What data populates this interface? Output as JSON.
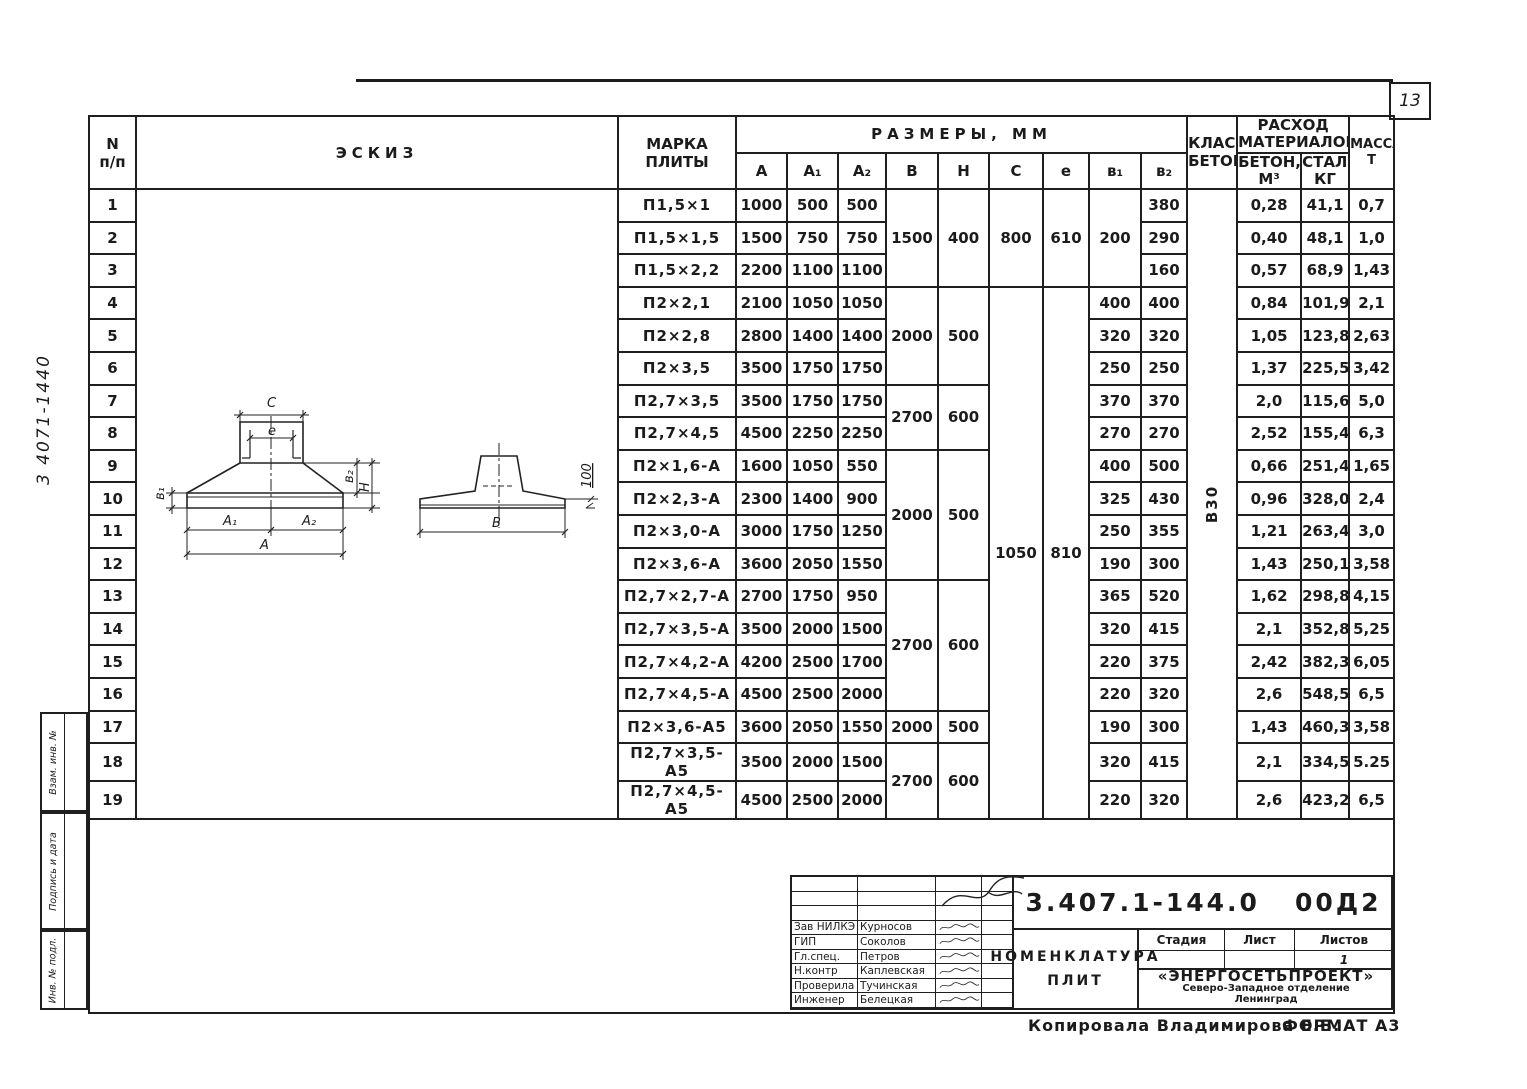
{
  "page": {
    "number": "13",
    "margin_code": "3 4071-1440",
    "stamps": [
      "Взам. инв. №",
      "Подпись и дата",
      "Инв. № подл."
    ],
    "copy_note": "Копировала  Владимирова Е.Б.",
    "format_note": "ФОРМАТ А3"
  },
  "table": {
    "header": {
      "num_l1": "N",
      "num_l2": "п/п",
      "sketch": "ЭСКИЗ",
      "mark_l1": "МАРКА",
      "mark_l2": "ПЛИТЫ",
      "dims": "РАЗМЕРЫ, ММ",
      "dim_cols": [
        "A",
        "A₁",
        "A₂",
        "B",
        "H",
        "C",
        "e",
        "в₁",
        "в₂"
      ],
      "class_l1": "КЛАСС",
      "class_l2": "БЕТОНА",
      "materials_l1": "РАСХОД",
      "materials_l2": "МАТЕРИАЛОВ",
      "concrete_l1": "БЕТОН,",
      "concrete_l2": "М³",
      "steel_l1": "СТАЛЬ,",
      "steel_l2": "КГ",
      "mass_l1": "МАССА,",
      "mass_l2": "Т"
    },
    "concrete_class": "В30",
    "rows": [
      {
        "n": "1",
        "mark": "П1,5×1",
        "A": "1000",
        "A1": "500",
        "A2": "500",
        "B": {
          "t": "1500",
          "rs": 3
        },
        "H": {
          "t": "400",
          "rs": 3
        },
        "C": {
          "t": "800",
          "rs": 3
        },
        "e": {
          "t": "610",
          "rs": 3
        },
        "B1": {
          "t": "200",
          "rs": 3
        },
        "B2": "380",
        "concrete": "0,28",
        "steel": "41,1",
        "mass": "0,7"
      },
      {
        "n": "2",
        "mark": "П1,5×1,5",
        "A": "1500",
        "A1": "750",
        "A2": "750",
        "B2": "290",
        "concrete": "0,40",
        "steel": "48,1",
        "mass": "1,0"
      },
      {
        "n": "3",
        "mark": "П1,5×2,2",
        "A": "2200",
        "A1": "1100",
        "A2": "1100",
        "B2": "160",
        "concrete": "0,57",
        "steel": "68,9",
        "mass": "1,43"
      },
      {
        "n": "4",
        "mark": "П2×2,1",
        "A": "2100",
        "A1": "1050",
        "A2": "1050",
        "B": {
          "t": "2000",
          "rs": 3
        },
        "H": {
          "t": "500",
          "rs": 3
        },
        "C": {
          "t": "1050",
          "rs": 16
        },
        "e": {
          "t": "810",
          "rs": 16
        },
        "B1": "400",
        "B2": "400",
        "concrete": "0,84",
        "steel": "101,9",
        "mass": "2,1"
      },
      {
        "n": "5",
        "mark": "П2×2,8",
        "A": "2800",
        "A1": "1400",
        "A2": "1400",
        "B1": "320",
        "B2": "320",
        "concrete": "1,05",
        "steel": "123,8",
        "mass": "2,63"
      },
      {
        "n": "6",
        "mark": "П2×3,5",
        "A": "3500",
        "A1": "1750",
        "A2": "1750",
        "B1": "250",
        "B2": "250",
        "concrete": "1,37",
        "steel": "225,5",
        "mass": "3,42"
      },
      {
        "n": "7",
        "mark": "П2,7×3,5",
        "A": "3500",
        "A1": "1750",
        "A2": "1750",
        "B": {
          "t": "2700",
          "rs": 2
        },
        "H": {
          "t": "600",
          "rs": 2
        },
        "B1": "370",
        "B2": "370",
        "concrete": "2,0",
        "steel": "115,6",
        "mass": "5,0"
      },
      {
        "n": "8",
        "mark": "П2,7×4,5",
        "A": "4500",
        "A1": "2250",
        "A2": "2250",
        "B1": "270",
        "B2": "270",
        "concrete": "2,52",
        "steel": "155,4",
        "mass": "6,3"
      },
      {
        "n": "9",
        "mark": "П2×1,6-А",
        "A": "1600",
        "A1": "1050",
        "A2": "550",
        "B": {
          "t": "2000",
          "rs": 4
        },
        "H": {
          "t": "500",
          "rs": 4
        },
        "B1": "400",
        "B2": "500",
        "concrete": "0,66",
        "steel": "251,4",
        "mass": "1,65"
      },
      {
        "n": "10",
        "mark": "П2×2,3-А",
        "A": "2300",
        "A1": "1400",
        "A2": "900",
        "B1": "325",
        "B2": "430",
        "concrete": "0,96",
        "steel": "328,0",
        "mass": "2,4"
      },
      {
        "n": "11",
        "mark": "П2×3,0-А",
        "A": "3000",
        "A1": "1750",
        "A2": "1250",
        "B1": "250",
        "B2": "355",
        "concrete": "1,21",
        "steel": "263,4",
        "mass": "3,0"
      },
      {
        "n": "12",
        "mark": "П2×3,6-А",
        "A": "3600",
        "A1": "2050",
        "A2": "1550",
        "B1": "190",
        "B2": "300",
        "concrete": "1,43",
        "steel": "250,1",
        "mass": "3,58"
      },
      {
        "n": "13",
        "mark": "П2,7×2,7-А",
        "A": "2700",
        "A1": "1750",
        "A2": "950",
        "B": {
          "t": "2700",
          "rs": 4
        },
        "H": {
          "t": "600",
          "rs": 4
        },
        "B1": "365",
        "B2": "520",
        "concrete": "1,62",
        "steel": "298,8",
        "mass": "4,15"
      },
      {
        "n": "14",
        "mark": "П2,7×3,5-А",
        "A": "3500",
        "A1": "2000",
        "A2": "1500",
        "B1": "320",
        "B2": "415",
        "concrete": "2,1",
        "steel": "352,8",
        "mass": "5,25"
      },
      {
        "n": "15",
        "mark": "П2,7×4,2-А",
        "A": "4200",
        "A1": "2500",
        "A2": "1700",
        "B1": "220",
        "B2": "375",
        "concrete": "2,42",
        "steel": "382,3",
        "mass": "6,05"
      },
      {
        "n": "16",
        "mark": "П2,7×4,5-А",
        "A": "4500",
        "A1": "2500",
        "A2": "2000",
        "B1": "220",
        "B2": "320",
        "concrete": "2,6",
        "steel": "548,5",
        "mass": "6,5"
      },
      {
        "n": "17",
        "mark": "П2×3,6-А5",
        "A": "3600",
        "A1": "2050",
        "A2": "1550",
        "B": "2000",
        "H": "500",
        "B1": "190",
        "B2": "300",
        "concrete": "1,43",
        "steel": "460,3",
        "mass": "3,58"
      },
      {
        "n": "18",
        "mark": "П2,7×3,5-А5",
        "A": "3500",
        "A1": "2000",
        "A2": "1500",
        "B": {
          "t": "2700",
          "rs": 2
        },
        "H": {
          "t": "600",
          "rs": 2
        },
        "B1": "320",
        "B2": "415",
        "concrete": "2,1",
        "steel": "334,5",
        "mass": "5.25"
      },
      {
        "n": "19",
        "mark": "П2,7×4,5-А5",
        "A": "4500",
        "A1": "2500",
        "A2": "2000",
        "B1": "220",
        "B2": "320",
        "concrete": "2,6",
        "steel": "423,2",
        "mass": "6,5"
      }
    ]
  },
  "sketch": {
    "labels": {
      "c": "C",
      "e": "e",
      "b1": "в₁",
      "b2": "в₂",
      "h": "H",
      "a1": "A₁",
      "a2": "A₂",
      "a": "A",
      "b": "B",
      "elev": "100"
    }
  },
  "title_block": {
    "doc_number": "3.407.1-144.0   00Д2",
    "people": [
      {
        "role": "Зав НИЛКЭ",
        "name": "Курносов"
      },
      {
        "role": "ГИП",
        "name": "Соколов"
      },
      {
        "role": "Гл.спец.",
        "name": "Петров"
      },
      {
        "role": "Н.контр",
        "name": "Каплевская"
      },
      {
        "role": "Проверила",
        "name": "Тучинская"
      },
      {
        "role": "Инженер",
        "name": "Белецкая"
      }
    ],
    "title_l1": "НОМЕНКЛАТУРА",
    "title_l2": "ПЛИТ",
    "stage_label": "Стадия",
    "sheet_label": "Лист",
    "sheets_label": "Листов",
    "stage_value": "",
    "sheet_value": "",
    "sheets_value": "1",
    "org_name": "«ЭНЕРГОСЕТЬПРОЕКТ»",
    "org_branch": "Северо-Западное отделение",
    "org_city": "Ленинград"
  }
}
